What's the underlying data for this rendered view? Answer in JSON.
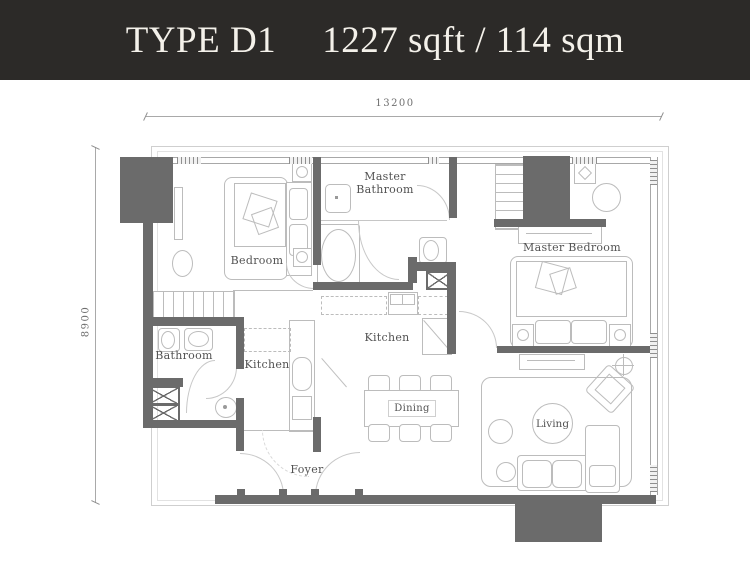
{
  "header": {
    "unit_type": "TYPE D1",
    "area": "1227 sqft / 114 sqm"
  },
  "dimensions": {
    "width_mm": "13200",
    "depth_mm": "8900"
  },
  "rooms": {
    "bedroom": "Bedroom",
    "master_bathroom": "Master Bathroom",
    "master_bedroom": "Master Bedroom",
    "bathroom": "Bathroom",
    "kitchen_wet": "Kitchen",
    "kitchen_dry": "Kitchen",
    "dining": "Dining",
    "living": "Living",
    "foyer": "Foyer"
  },
  "colors": {
    "title_bg": "#2c2a28",
    "title_text": "#f4f1ea",
    "wall": "#6b6b6b",
    "furniture_line": "#bcbcbc",
    "boundary_line": "#cfcfcf",
    "label_text": "#525252",
    "dim_text": "#6e6e6e",
    "plan_bg": "#ffffff"
  }
}
